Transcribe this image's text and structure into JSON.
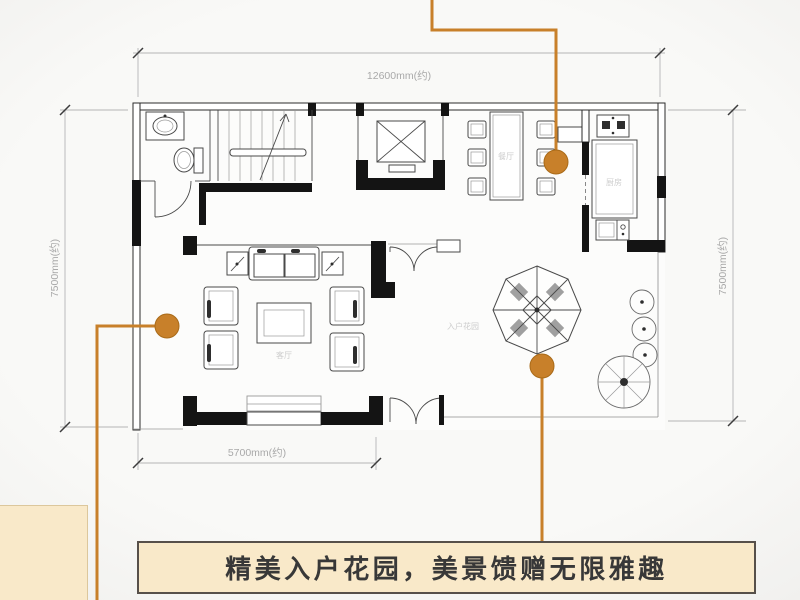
{
  "caption": {
    "text": "精美入户花园，美景馈赠无限雅趣"
  },
  "floor_plan": {
    "dimensions": {
      "top": "12600mm(约)",
      "left": "7500mm(约)",
      "right": "7500mm(约)",
      "bottom": "5700mm(约)"
    },
    "room_labels": {
      "living_room": "客厅",
      "dining_room": "餐厅",
      "kitchen": "厨房",
      "garden": "入户花园"
    },
    "colors": {
      "accent": "#C8802A",
      "wall": "#141414",
      "dim": "#A9A9A9",
      "caption_bg": "#F9E9C9",
      "caption_border": "#57504A",
      "caption_text": "#383838"
    }
  }
}
